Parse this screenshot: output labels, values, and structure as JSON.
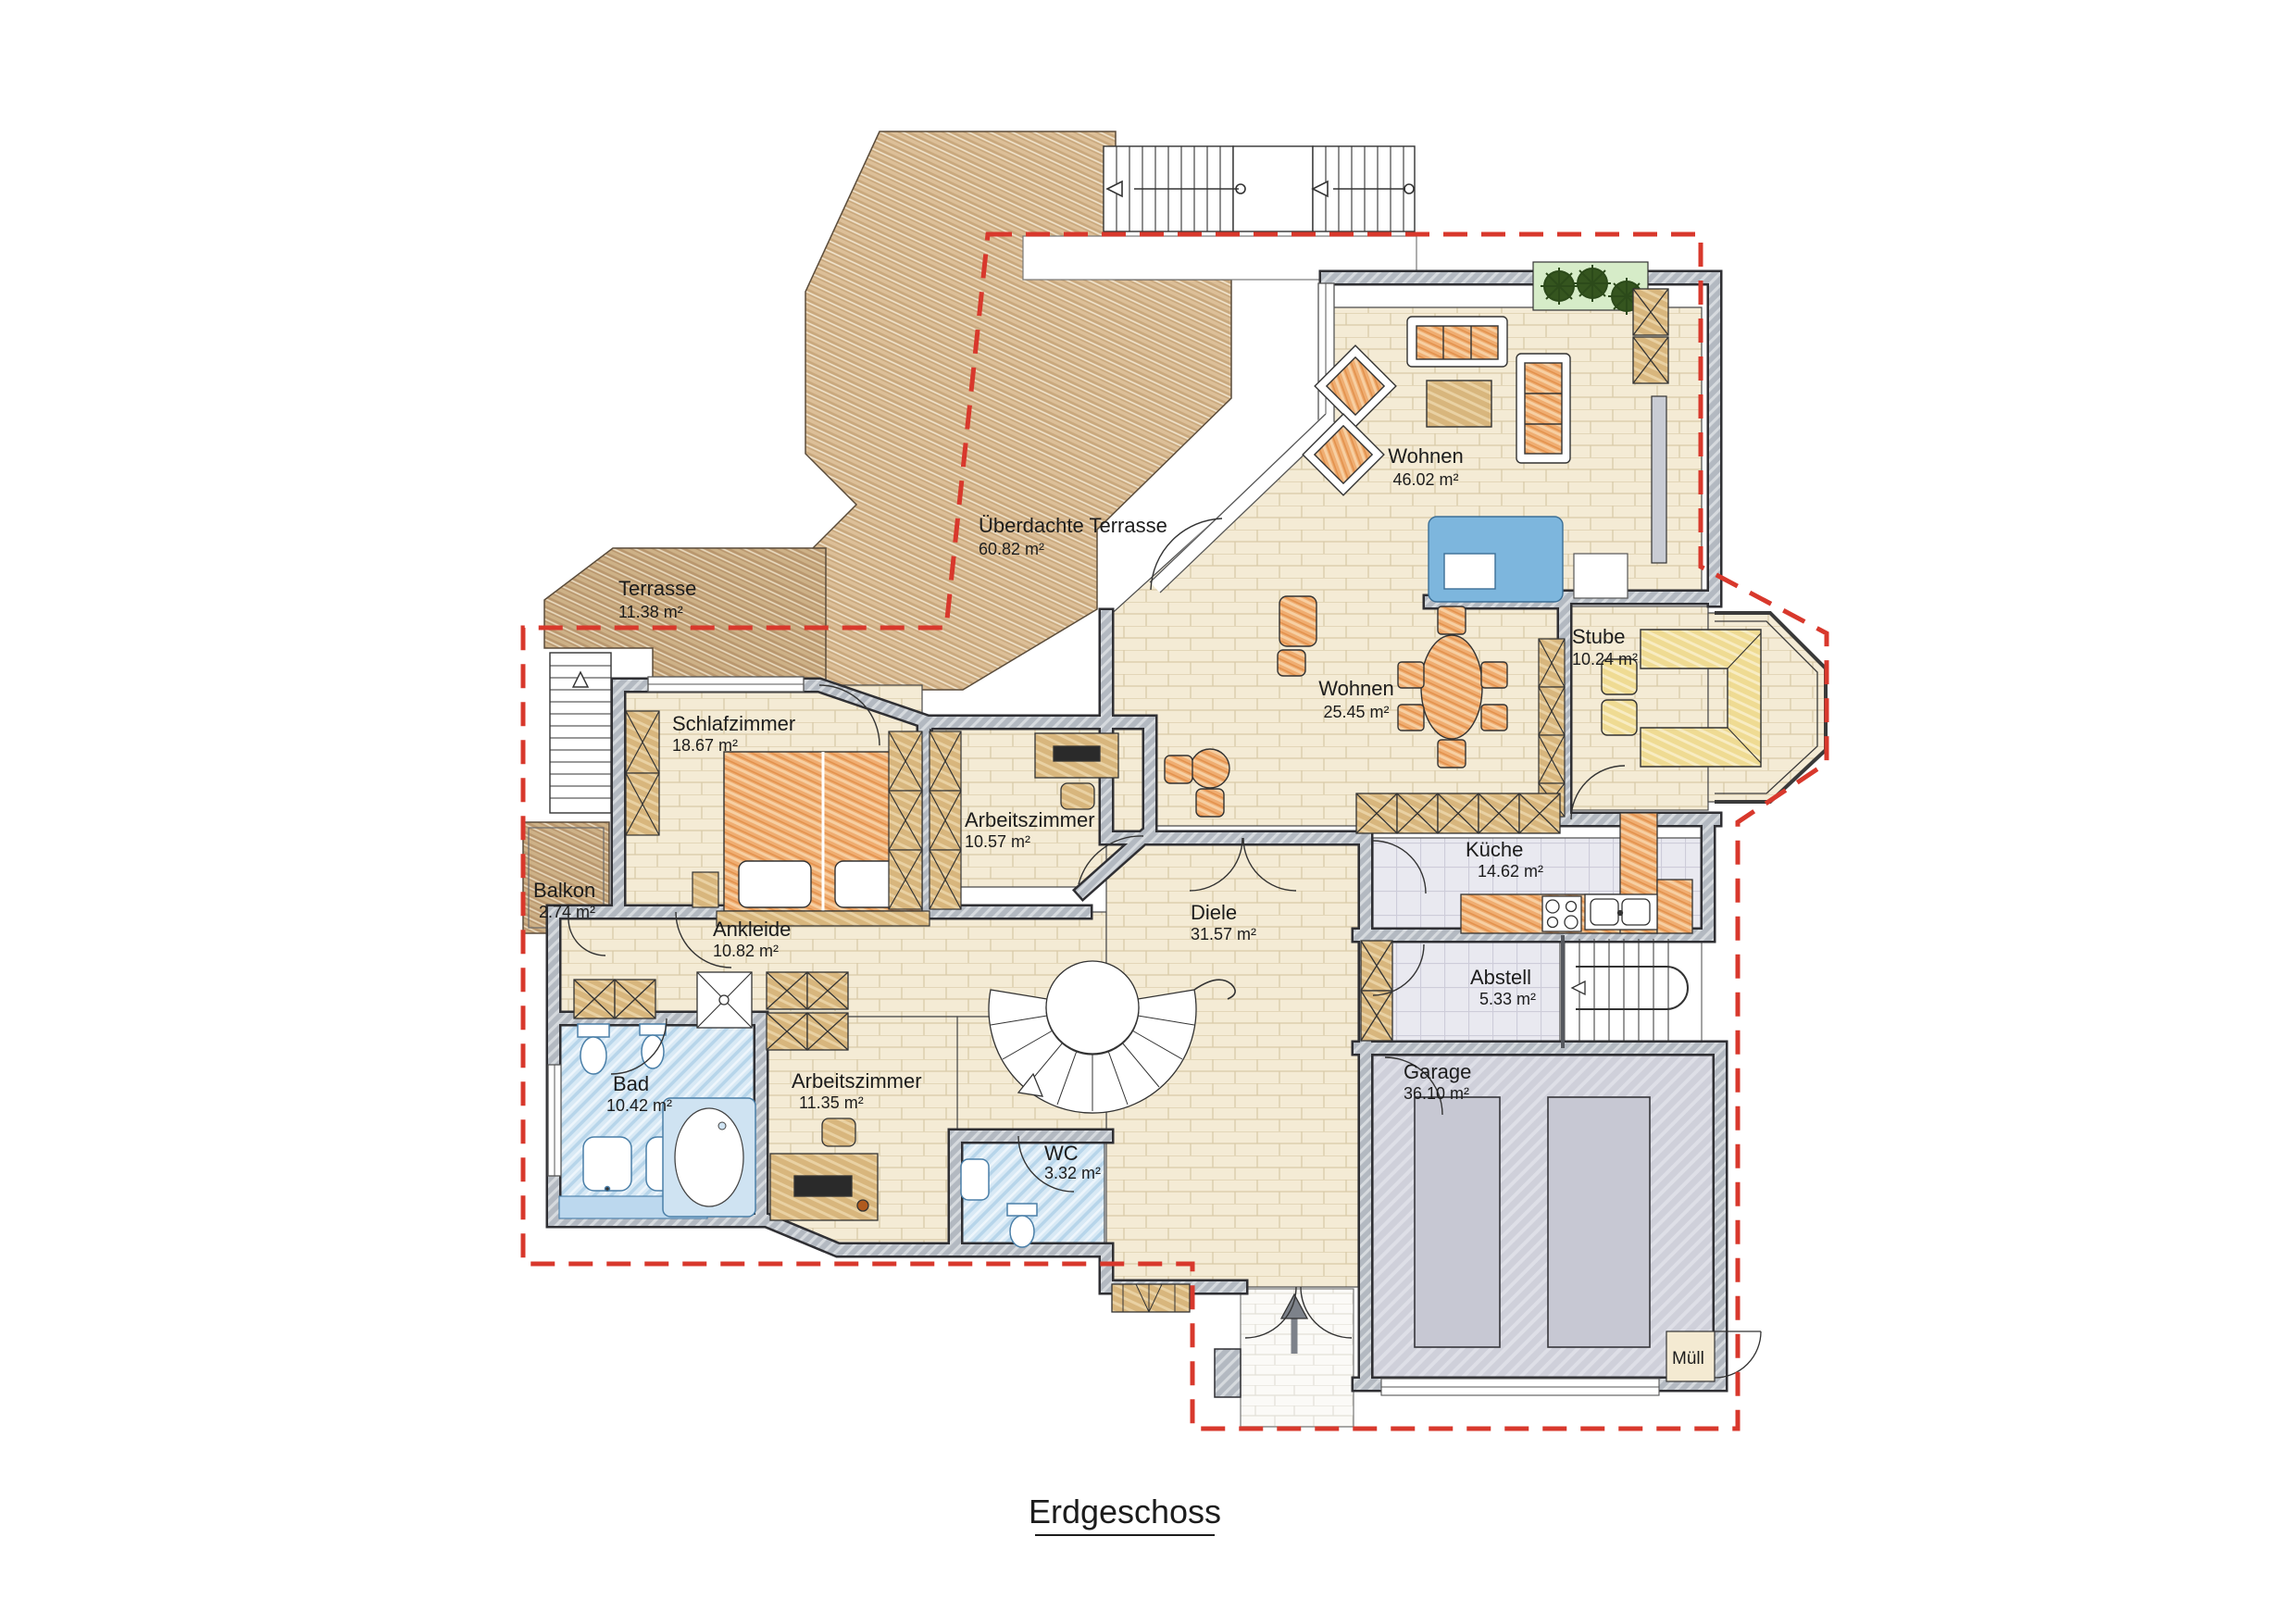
{
  "plan": {
    "title": "Erdgeschoss",
    "boundary_color": "#d8382c",
    "rooms": [
      {
        "id": "ueberdachte_terrasse",
        "name": "Überdachte Terrasse",
        "area": "60.82 m²"
      },
      {
        "id": "terrasse",
        "name": "Terrasse",
        "area": "11.38 m²"
      },
      {
        "id": "wohnen_gross",
        "name": "Wohnen",
        "area": "46.02 m²"
      },
      {
        "id": "wohnen_ess",
        "name": "Wohnen",
        "area": "25.45 m²"
      },
      {
        "id": "stube",
        "name": "Stube",
        "area": "10.24 m²"
      },
      {
        "id": "schlafzimmer",
        "name": "Schlafzimmer",
        "area": "18.67 m²"
      },
      {
        "id": "arbeitszimmer_ost",
        "name": "Arbeitszimmer",
        "area": "10.57 m²"
      },
      {
        "id": "balkon",
        "name": "Balkon",
        "area": "2.74 m²"
      },
      {
        "id": "ankleide",
        "name": "Ankleide",
        "area": "10.82 m²"
      },
      {
        "id": "bad",
        "name": "Bad",
        "area": "10.42 m²"
      },
      {
        "id": "arbeitszimmer_sued",
        "name": "Arbeitszimmer",
        "area": "11.35 m²"
      },
      {
        "id": "wc",
        "name": "WC",
        "area": "3.32 m²"
      },
      {
        "id": "diele",
        "name": "Diele",
        "area": "31.57 m²"
      },
      {
        "id": "kueche",
        "name": "Küche",
        "area": "14.62 m²"
      },
      {
        "id": "abstell",
        "name": "Abstell",
        "area": "5.33 m²"
      },
      {
        "id": "garage",
        "name": "Garage",
        "area": "36.10 m²"
      },
      {
        "id": "muell",
        "name": "Müll",
        "area": ""
      }
    ]
  }
}
